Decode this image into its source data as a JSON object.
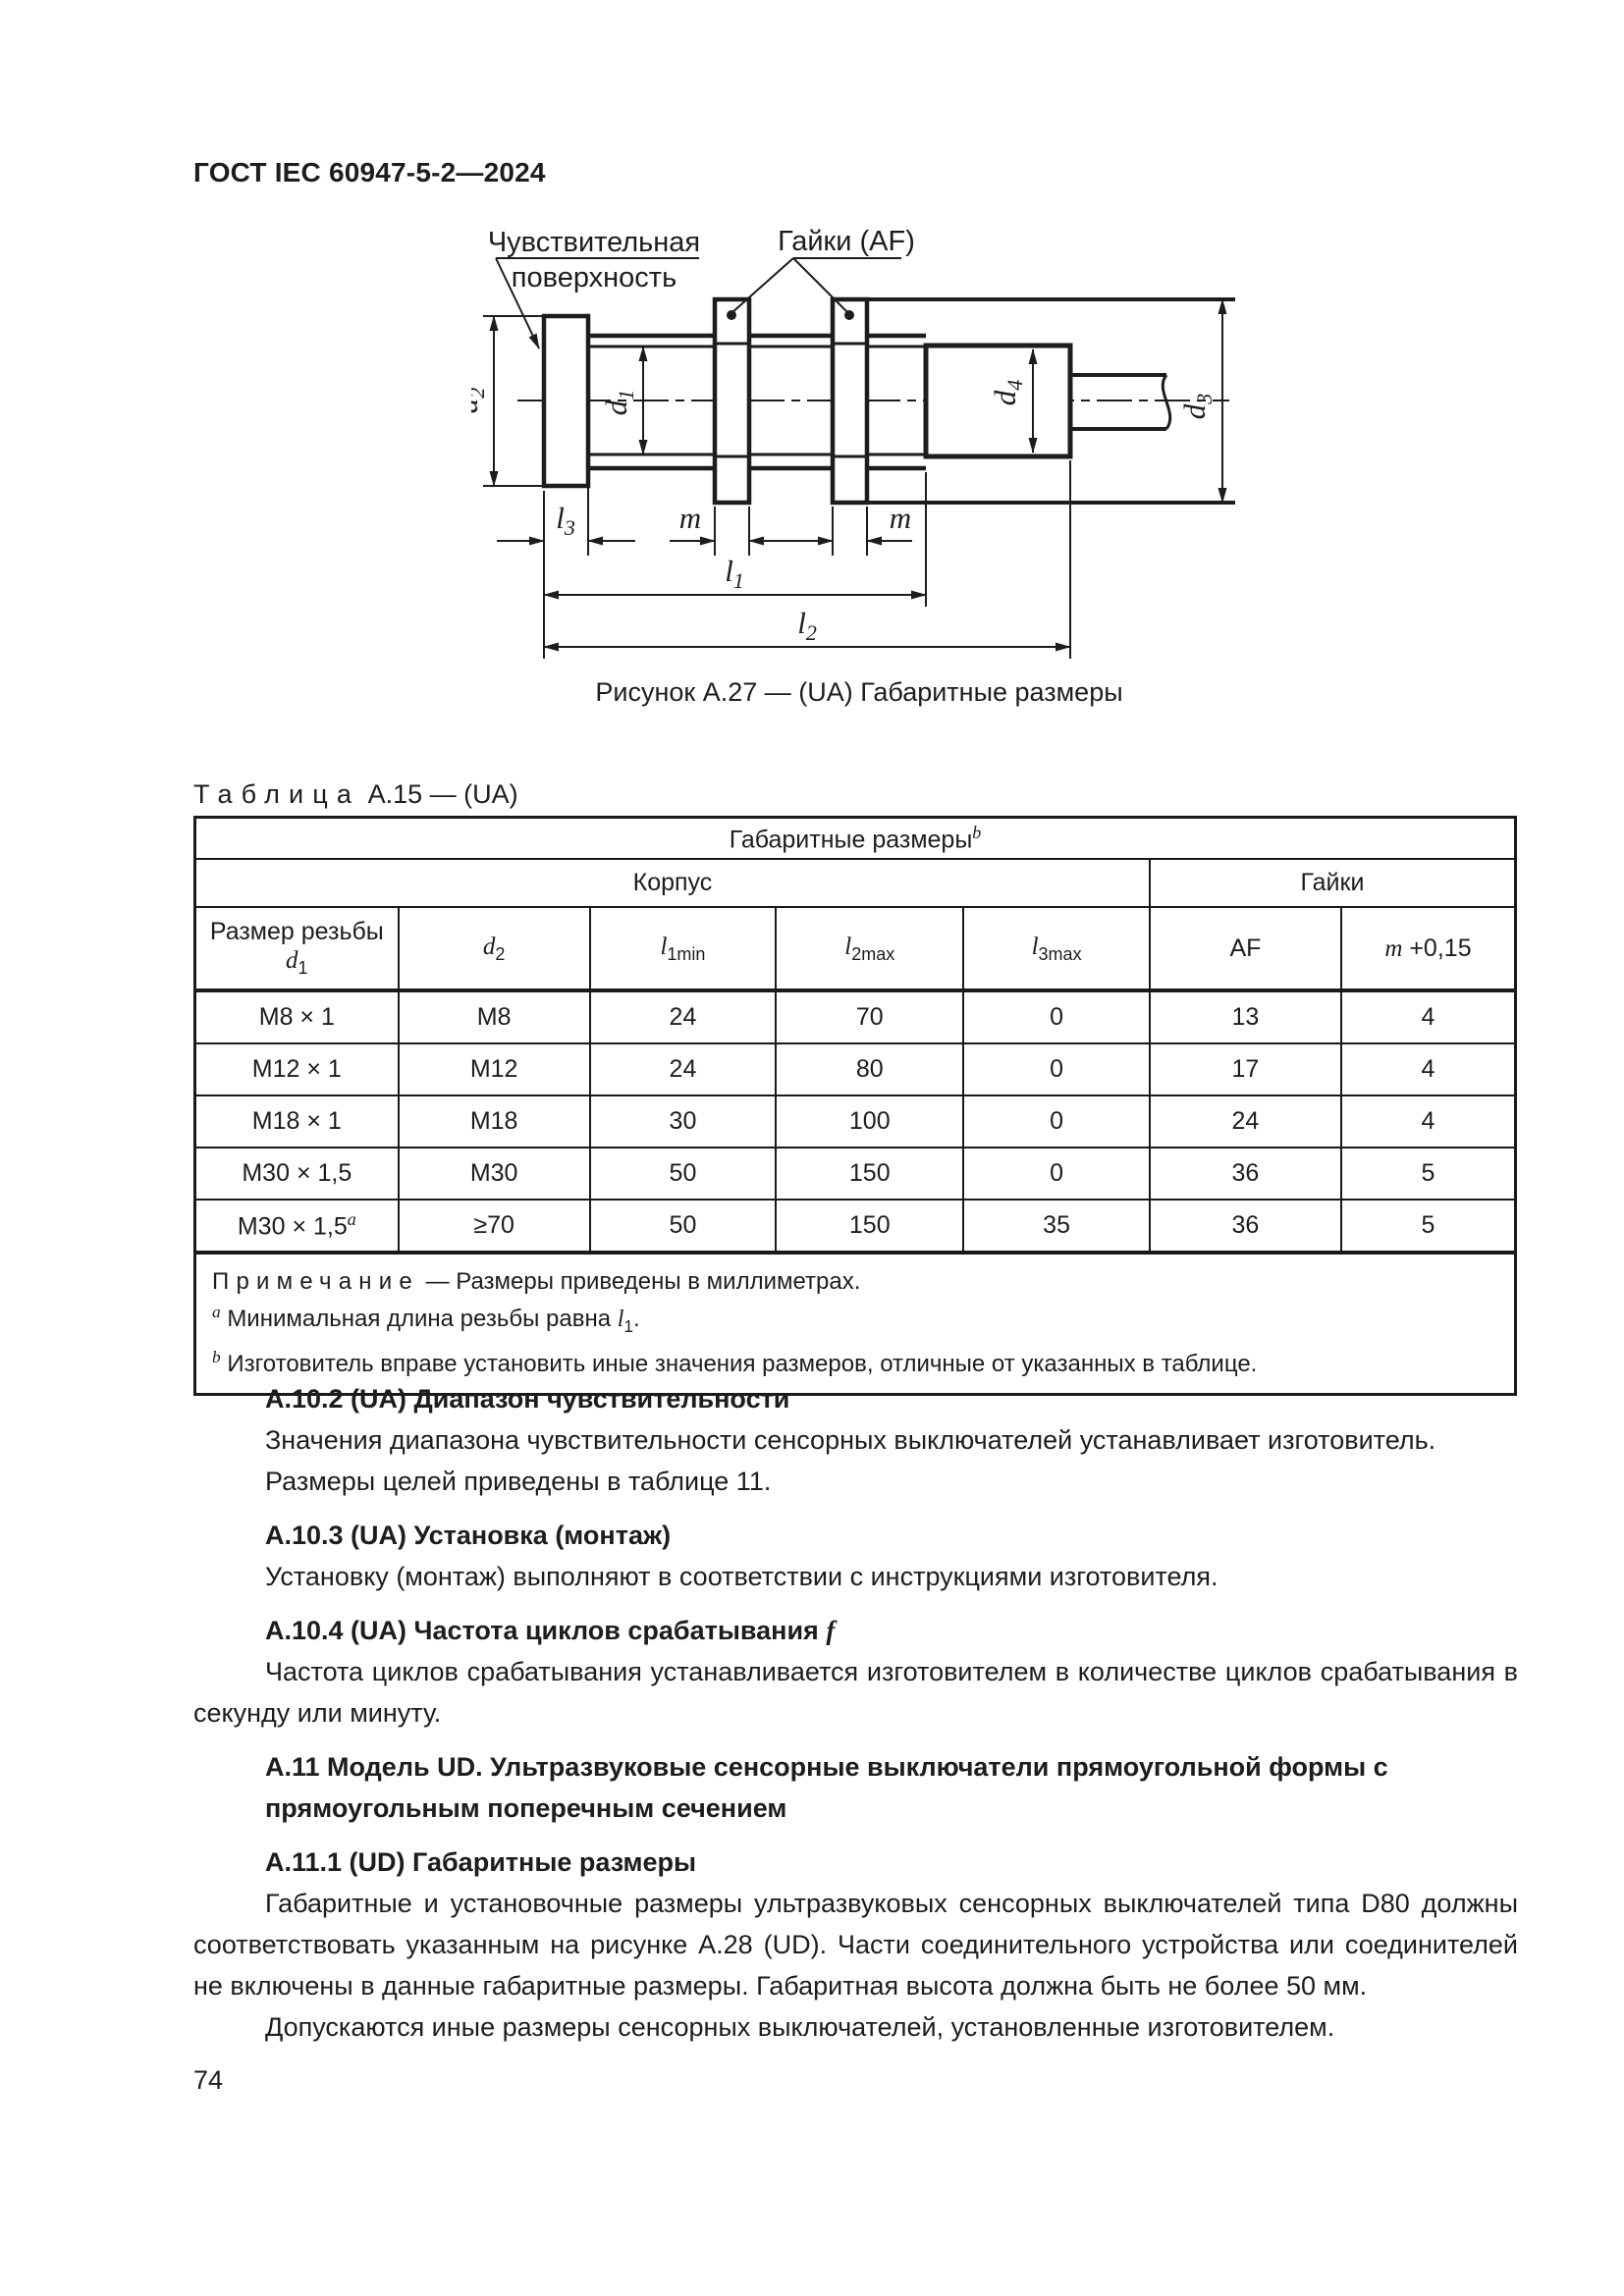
{
  "page": {
    "header": "ГОСТ IEC 60947-5-2—2024",
    "number": "74"
  },
  "figure": {
    "caption": "Рисунок А.27 — (UA) Габаритные размеры",
    "labels": {
      "sensing_line1": "Чувствительная",
      "sensing_line2": "поверхность",
      "nuts": "Гайки (AF)"
    },
    "dims": {
      "d1": {
        "base": "d",
        "sub": "1"
      },
      "d2": {
        "base": "d",
        "sub": "2"
      },
      "d3": {
        "base": "d",
        "sub": "3"
      },
      "d4": {
        "base": "d",
        "sub": "4"
      },
      "l1": {
        "base": "l",
        "sub": "1"
      },
      "l2": {
        "base": "l",
        "sub": "2"
      },
      "l3": {
        "base": "l",
        "sub": "3"
      },
      "m1": {
        "base": "m"
      },
      "m2": {
        "base": "m"
      }
    }
  },
  "table": {
    "title_word": "Таблица",
    "title_rest": " А.15 — (UA)",
    "span_header": {
      "text": "Габаритные размеры",
      "sup": "b"
    },
    "groups": {
      "body": "Корпус",
      "nuts": "Гайки"
    },
    "columns": [
      {
        "line1": "Размер резьбы",
        "base": "d",
        "sub": "1"
      },
      {
        "base": "d",
        "sub": "2"
      },
      {
        "base": "l",
        "sub": "1min"
      },
      {
        "base": "l",
        "sub": "2max"
      },
      {
        "base": "l",
        "sub": "3max"
      },
      {
        "text": "AF"
      },
      {
        "base": "m",
        "rest": " +0,15"
      }
    ],
    "rows": [
      [
        "М8 × 1",
        "М8",
        "24",
        "70",
        "0",
        "13",
        "4"
      ],
      [
        "М12 × 1",
        "М12",
        "24",
        "80",
        "0",
        "17",
        "4"
      ],
      [
        "М18 × 1",
        "М18",
        "30",
        "100",
        "0",
        "24",
        "4"
      ],
      [
        "М30 × 1,5",
        "М30",
        "50",
        "150",
        "0",
        "36",
        "5"
      ],
      [
        "М30 × 1,5",
        "≥70",
        "50",
        "150",
        "35",
        "36",
        "5"
      ]
    ],
    "row5_sup": "a",
    "note_label": "Примечание",
    "note_text": " — Размеры приведены в миллиметрах.",
    "footnote_a": {
      "sup": "a",
      "before": "Минимальная длина резьбы равна ",
      "dim_base": "l",
      "dim_sub": "1",
      "after": "."
    },
    "footnote_b": {
      "sup": "b",
      "text": "Изготовитель вправе установить иные значения размеров, отличные от указанных в таблице."
    }
  },
  "sections": {
    "s1": {
      "heading": "А.10.2  (UA) Диапазон чувствительности",
      "p1": "Значения диапазона чувствительности сенсорных выключателей устанавливает изготовитель.",
      "p2": "Размеры целей приведены в таблице 11."
    },
    "s2": {
      "heading": "А.10.3  (UA) Установка (монтаж)",
      "p1": "Установку (монтаж) выполняют в соответствии с инструкциями изготовителя."
    },
    "s3": {
      "heading_base": "А.10.4  (UA) Частота циклов срабатывания ",
      "heading_italic": "f",
      "p1": "Частота циклов срабатывания устанавливается изготовителем в количестве циклов срабатывания в секунду или минуту."
    },
    "s4": {
      "heading": "А.11  Модель UD. Ультразвуковые сенсорные выключатели прямоугольной формы с прямоугольным поперечным сечением"
    },
    "s5": {
      "heading": "А.11.1  (UD) Габаритные размеры",
      "p1": "Габаритные и установочные размеры ультразвуковых сенсорных выключателей типа D80 должны соответствовать указанным на рисунке А.28 (UD). Части соединительного устройства или соединителей не включены в данные габаритные размеры. Габаритная высота должна быть не более 50  мм.",
      "p2": "Допускаются иные размеры сенсорных выключателей, установленные изготовителем."
    }
  }
}
